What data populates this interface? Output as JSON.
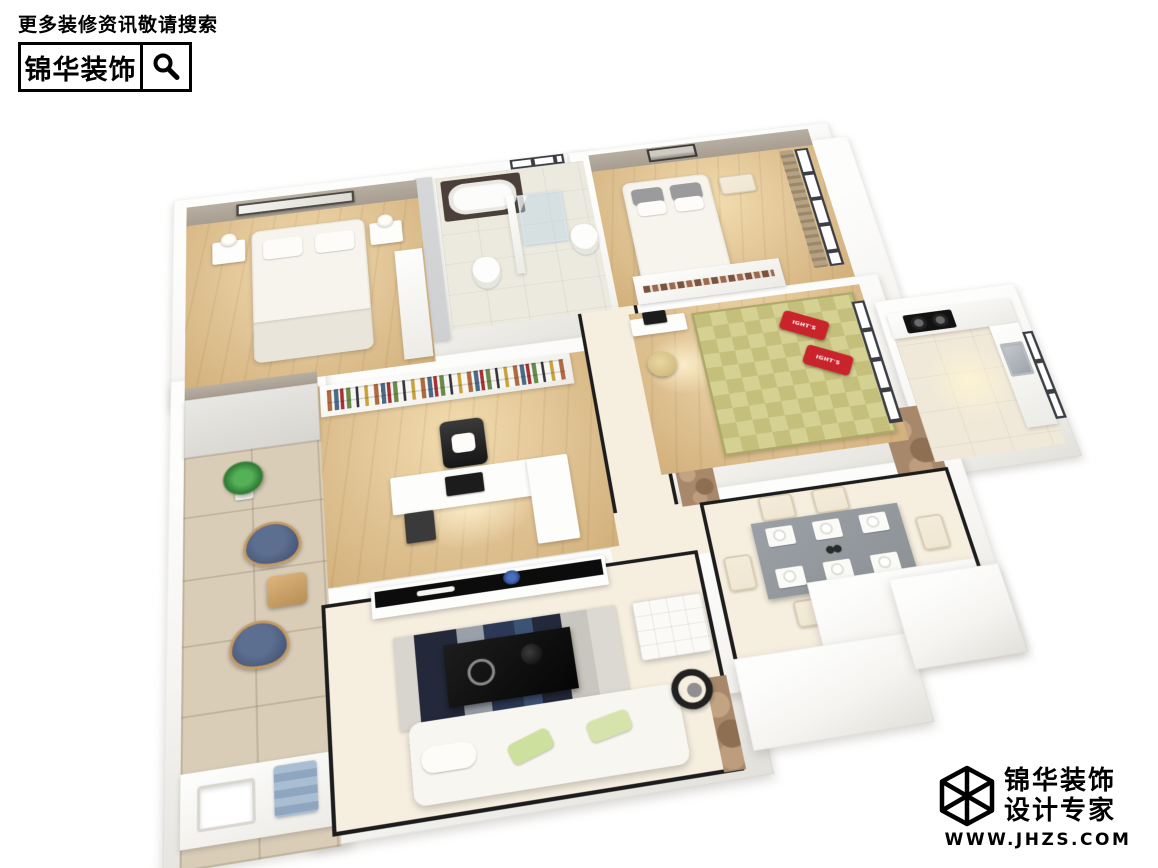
{
  "watermark_top": {
    "search_hint": "更多装修资讯敬请搜索",
    "brand": "锦华装饰",
    "icon": "magnifier-icon"
  },
  "watermark_bottom": {
    "icon": "cube-logo-icon",
    "brand_line1": "锦华装饰",
    "brand_line2": "设计专家",
    "website": "WWW.JHZS.COM"
  },
  "floorplan": {
    "view": "3d-isometric-apartment-render",
    "pillow_text": "IGHT'S",
    "rooms": [
      {
        "name": "master-bedroom",
        "furniture": [
          "double-bed",
          "pillows",
          "nightstand-left",
          "nightstand-right",
          "table-lamps",
          "wall-art",
          "wardrobe"
        ]
      },
      {
        "name": "bathroom",
        "furniture": [
          "bathtub",
          "marble-tub-deck",
          "glass-shower",
          "toilet-left",
          "toilet-right",
          "window"
        ]
      },
      {
        "name": "bedroom-2",
        "furniture": [
          "double-bed",
          "gray-pillows",
          "eiffel-tower-art",
          "bench",
          "sliding-wardrobe",
          "window",
          "curtain"
        ]
      },
      {
        "name": "tatami-room",
        "furniture": [
          "tatami-mat",
          "red-pillows",
          "desk",
          "monitor",
          "round-chair",
          "window"
        ]
      },
      {
        "name": "study",
        "furniture": [
          "bookshelf",
          "office-chair",
          "l-shaped-desk",
          "monitor",
          "drawer-unit"
        ]
      },
      {
        "name": "kitchen",
        "furniture": [
          "gas-cooktop",
          "sink",
          "counters",
          "window"
        ]
      },
      {
        "name": "dining-room",
        "furniture": [
          "dining-table",
          "six-chairs",
          "place-settings",
          "island-half-wall"
        ]
      },
      {
        "name": "living-room",
        "furniture": [
          "sofa",
          "green-pillows",
          "coffee-table",
          "area-rug",
          "tv-cabinet",
          "flower-vase",
          "ottoman",
          "floor-lamp"
        ]
      },
      {
        "name": "balcony",
        "furniture": [
          "tall-cabinet",
          "potted-plant",
          "navy-armchair-1",
          "navy-armchair-2",
          "side-table",
          "laundry-sink",
          "blue-towel"
        ]
      },
      {
        "name": "hallway",
        "furniture": [
          "black-baseboard-lines",
          "marble-threshold"
        ]
      }
    ]
  },
  "colors": {
    "bg": "#ffffff",
    "ink": "#111111",
    "wall": "#f5f4f1",
    "wall-bright": "#fdfdfc",
    "wall-shade": "#e2e0da",
    "taupe-wall": "#a79d90",
    "gray-wall": "#cfd0d2",
    "wood": "#e0c394",
    "wood-deep": "#d2b07b",
    "tile-balcony": "#d9cdb8",
    "tile-bath": "#eceadf",
    "cream-floor": "#f6efe0",
    "marble": "#a8886b",
    "tatami": "#d5d192",
    "tatami-dark": "#c5bf7c",
    "red-pillow": "#c9242b",
    "navy-chair": "#49597a",
    "plant": "#3e9441",
    "black-furniture": "#101010",
    "dining-table": "#8d9297",
    "cream-furniture": "#efe6d2",
    "glass": "#bcd3e2",
    "window-frame": "#3b3f45",
    "curtain": "#b5a183",
    "baseboard": "#1c1c1c"
  }
}
